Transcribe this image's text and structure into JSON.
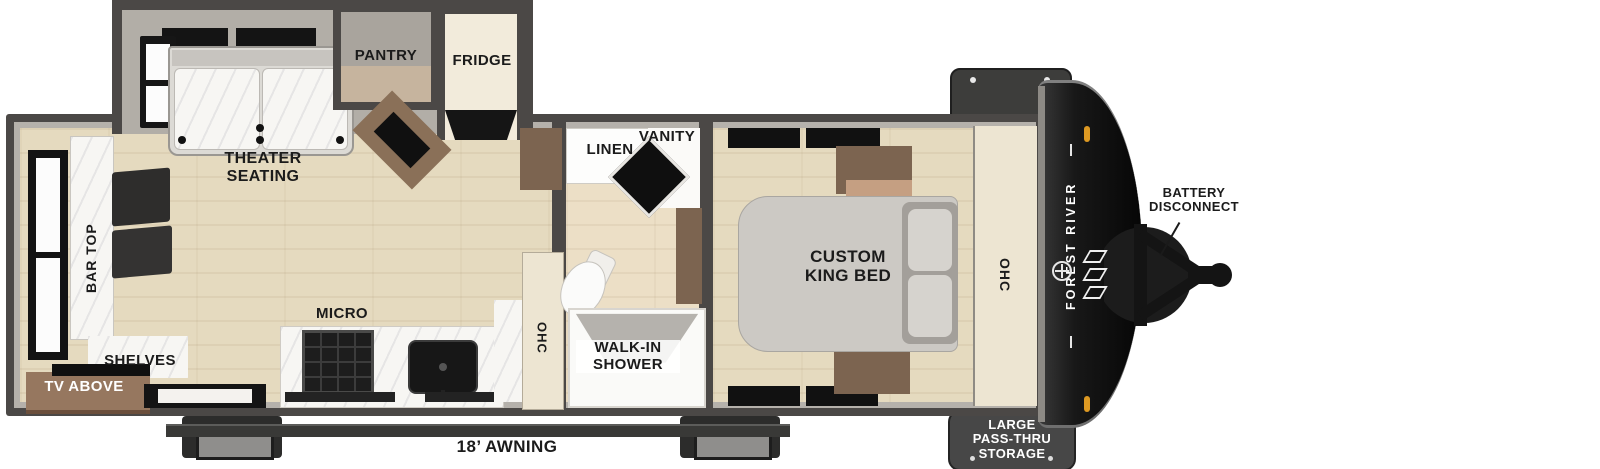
{
  "plan": {
    "labels": {
      "theater_seating": "THEATER\nSEATING",
      "pantry": "PANTRY",
      "fridge": "FRIDGE",
      "bar_top": "BAR TOP",
      "shelves": "SHELVES",
      "tv_above": "TV ABOVE",
      "micro": "MICRO",
      "kitchen_ohc": "OHC",
      "linen": "LINEN",
      "vanity": "VANITY",
      "walk_in_shower": "WALK-IN\nSHOWER",
      "custom_king_bed": "CUSTOM\nKING BED",
      "bedroom_ohc": "OHC",
      "awning": "18’ AWNING",
      "battery_disconnect": "BATTERY\nDISCONNECT",
      "pass_thru_storage": "LARGE\nPASS-THRU\nSTORAGE"
    },
    "brand": {
      "name": "FOREST RIVER"
    },
    "colors": {
      "wall": "#4b4846",
      "wall_fill": "#b5b1ab",
      "floor_wood": "#e5dabf",
      "counter_marble": "#f7f6f3",
      "cabinet_brown": "#7c6450",
      "cabinet_tan": "#c59f82",
      "bed_gray": "#ccc9c4",
      "cream_cabinet": "#ede5d2",
      "front_cap_black": "#181818",
      "clearance_light_amber": "#dd9922",
      "label_black": "#1b1b1b",
      "label_white": "#ffffff"
    }
  }
}
